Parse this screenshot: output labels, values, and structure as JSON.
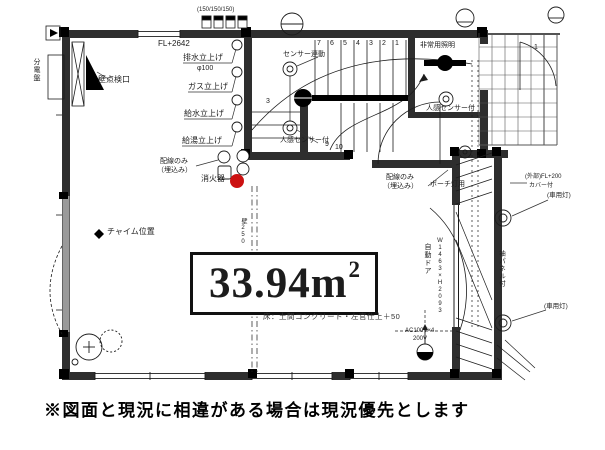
{
  "plan": {
    "area": {
      "value": "33.94",
      "unit": "m",
      "sup": "2"
    },
    "floor_note": "床：土間コンクリート・左官仕上＋50",
    "disclaimer": "※図面と現況に相違がある場合は現況優先とします",
    "colors": {
      "line": "#1c1c1c",
      "fire_extinguisher_dot": "#cc1111",
      "gray_wall": "#9a9a9a"
    },
    "labels": {
      "meter_note": "(150/150/150)",
      "fl_level": "FL+2642",
      "drain_riser": "排水立上げ",
      "drain_dia": "φ100",
      "gas_riser": "ガス立上げ",
      "water_riser": "給水立上げ",
      "hot_water_riser": "給湯立上げ",
      "wiring_only_line1": "配線のみ",
      "wiring_only_line2": "（埋込み）",
      "fire_extinguisher": "消火器",
      "wall_access": "壁点検口",
      "chime": "チャイム位置",
      "sensor_linked": "センサー連動",
      "motion_sensor_stair": "人感センサー付",
      "ceiling_light": "非常用照明",
      "motion_sensor_hall": "人感センサー付",
      "wiring_porch_line1": "配線のみ",
      "wiring_porch_line2": "（埋込み）",
      "porch_light": "ポーチ灯用",
      "auto_door": "自動ドア",
      "auto_door_size": "W1463×H2093",
      "side_panel": "袖パネル付",
      "car_light_top": "(車用灯)",
      "car_light_bottom": "(車用灯)",
      "tile_note_line1": "(外部)FL+200",
      "tile_note_line2": "カバー付",
      "outlet_line1": "AC100V×4",
      "outlet_line2": "200V",
      "wall_thickness": "壁250",
      "panel_board": "分電盤",
      "grid_number": "1",
      "stair_number_side": "3"
    },
    "stair_numbers_upper": [
      "7",
      "6",
      "5",
      "4",
      "3",
      "2",
      "1"
    ],
    "stair_numbers_lower": [
      "9",
      "10"
    ]
  }
}
